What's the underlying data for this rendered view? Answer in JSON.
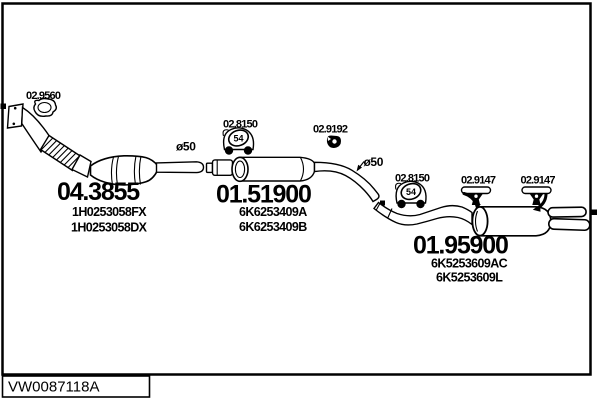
{
  "drawing": {
    "code": "VW0087118A",
    "background": "#ffffff",
    "line_color": "#000000"
  },
  "annotations": {
    "diameter_front": "ø50",
    "diameter_rear": "ø50"
  },
  "parts": {
    "gasket": {
      "number": "02.9560"
    },
    "front_pipe_cat": {
      "number": "04.3855",
      "refs": [
        "1H0253058FX",
        "1H0253058DX"
      ]
    },
    "clamp_front": {
      "number": "02.8150",
      "size": "54"
    },
    "middle_silencer": {
      "number": "01.51900",
      "refs": [
        "6K6253409A",
        "6K6253409B"
      ]
    },
    "rubber_mount": {
      "number": "02.9192"
    },
    "clamp_rear": {
      "number": "02.8150",
      "size": "54"
    },
    "hanger_front": {
      "number": "02.9147"
    },
    "hanger_rear": {
      "number": "02.9147"
    },
    "rear_silencer": {
      "number": "01.95900",
      "refs": [
        "6K5253609AC",
        "6K5253609L"
      ]
    }
  }
}
